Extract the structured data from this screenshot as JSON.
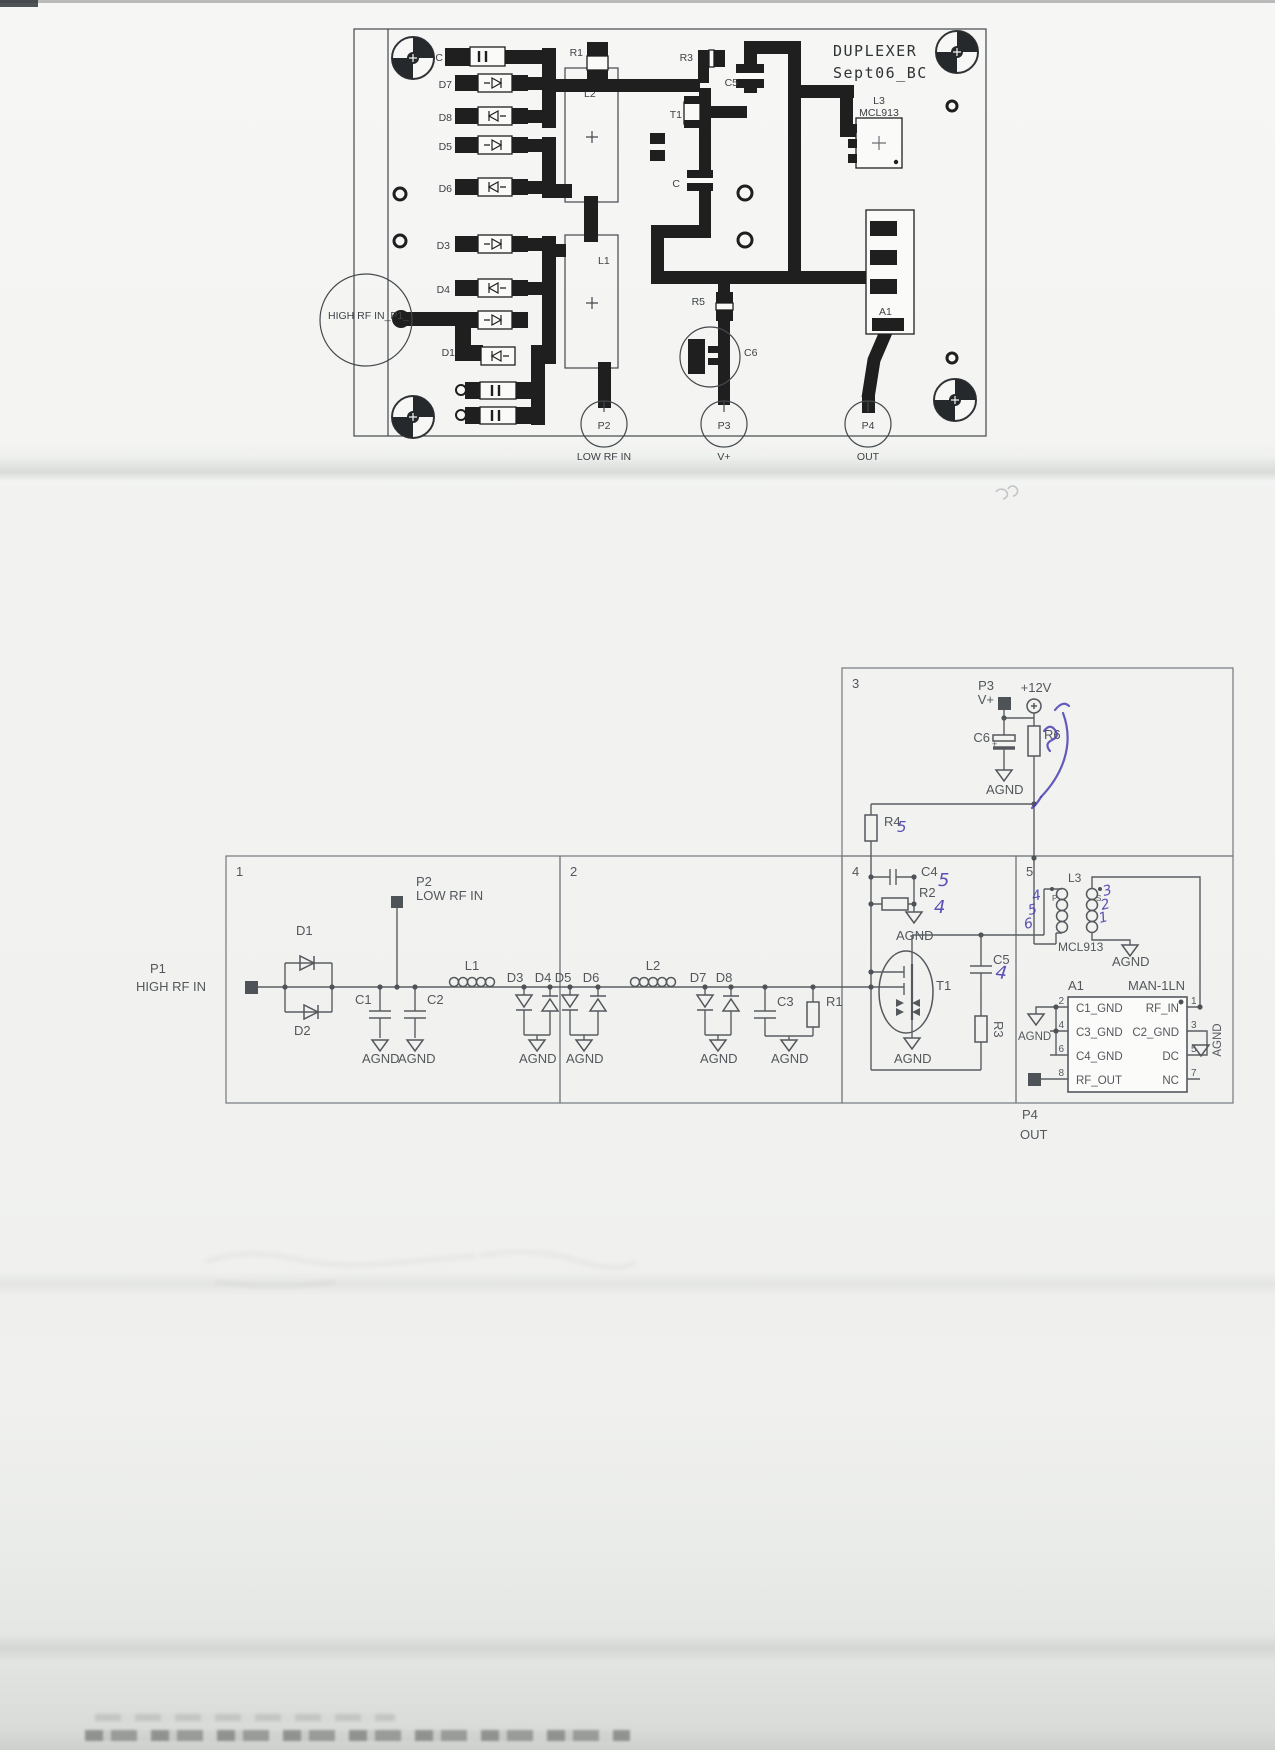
{
  "pcb": {
    "title_line1": "DUPLEXER",
    "title_line2": "Sept06_BC",
    "refs": {
      "c_top": "C",
      "r1": "R1",
      "r3": "R3",
      "c5": "C5",
      "t1": "T1",
      "l3": "L3",
      "l3_part": "MCL913",
      "l2": "L2",
      "l1": "L1",
      "d7": "D7",
      "d8": "D8",
      "d5": "D5",
      "d6": "D6",
      "d3": "D3",
      "d4": "D4",
      "d1": "D1",
      "r5": "R5",
      "c6": "C6",
      "c_mid": "C",
      "a1": "A1"
    },
    "connectors": {
      "p1_label": "HIGH RF IN_P1_",
      "p2": "P2",
      "p2_label": "LOW RF IN",
      "p3": "P3",
      "p3_label": "V+",
      "p4": "P4",
      "p4_label": "OUT"
    }
  },
  "sch": {
    "sections": {
      "s1": "1",
      "s2": "2",
      "s3": "3",
      "s4": "4",
      "s5": "5"
    },
    "gnd": "AGND",
    "ports": {
      "p1": "P1",
      "p1_label": "HIGH RF IN",
      "p2": "P2",
      "p2_label": "LOW RF IN",
      "p3": "P3",
      "p3_label": "V+",
      "v12": "+12V",
      "p4": "P4",
      "p4_label": "OUT"
    },
    "parts": {
      "d1": "D1",
      "d2": "D2",
      "c1": "C1",
      "c2": "C2",
      "l1": "L1",
      "d3": "D3",
      "d4": "D4",
      "d5": "D5",
      "d6": "D6",
      "l2": "L2",
      "d7": "D7",
      "d8": "D8",
      "c3": "C3",
      "r1": "R1",
      "r4": "R4",
      "c4": "C4",
      "r2": "R2",
      "t1": "T1",
      "c5": "C5",
      "r3": "R3",
      "c6": "C6",
      "c6_polarity": "+",
      "r6": "R6",
      "l3": "L3",
      "l3_part": "MCL913",
      "l3_p": "P",
      "l3_s": "S",
      "a1": "A1",
      "a1_part": "MAN-1LN"
    },
    "a1_pins": {
      "n2": "2",
      "n4": "4",
      "n6": "6",
      "n8": "8",
      "n1": "1",
      "n3": "3",
      "n5": "5",
      "n7": "7",
      "c1_gnd": "C1_GND",
      "c3_gnd": "C3_GND",
      "c4_gnd": "C4_GND",
      "rf_out": "RF_OUT",
      "rf_in": "RF_IN",
      "c2_gnd": "C2_GND",
      "dc": "DC",
      "nc": "NC"
    },
    "handwriting": {
      "ink_color": "#4a3fb0",
      "r4": "5",
      "c4": "5",
      "r2": "4",
      "c5": "4",
      "l3_left": [
        "4",
        "5",
        "6"
      ],
      "l3_right": [
        "3",
        "2",
        "1"
      ]
    }
  }
}
